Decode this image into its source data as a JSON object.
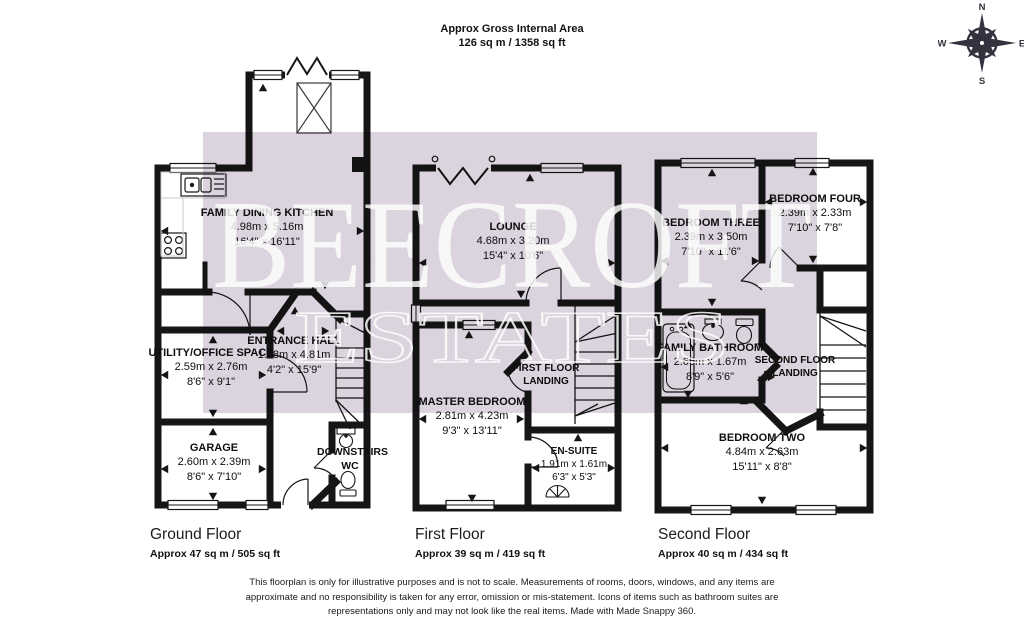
{
  "title": {
    "line1": "Approx Gross Internal Area",
    "line2": "126 sq m / 1358 sq ft"
  },
  "compass": {
    "north": "N",
    "east": "E",
    "south": "S",
    "west": "W"
  },
  "watermark": {
    "primary": "BEECROFT",
    "secondary": "ESTATES"
  },
  "colors": {
    "wall": "#161616",
    "watermark_fill": "#dbd3dd",
    "watermark_text": "#ffffff"
  },
  "floors": {
    "ground": {
      "caption": "Ground Floor",
      "area": "Approx 47 sq m / 505 sq ft",
      "rooms": {
        "kitchen": {
          "name": "FAMILY DINING KITCHEN",
          "metric": "4.98m x 5.16m",
          "imperial": "16'4\" x 16'11\""
        },
        "utility": {
          "name": "UTILITY/OFFICE SPACE",
          "metric": "2.59m x 2.76m",
          "imperial": "8'6\" x 9'1\""
        },
        "hall": {
          "name": "ENTRANCE HALL",
          "metric": "1.28m x 4.81m",
          "imperial": "4'2\" x 15'9\""
        },
        "garage": {
          "name": "GARAGE",
          "metric": "2.60m x 2.39m",
          "imperial": "8'6\" x 7'10\""
        },
        "wc": {
          "name": "DOWNSTAIRS WC"
        }
      }
    },
    "first": {
      "caption": "First Floor",
      "area": "Approx 39 sq m / 419 sq ft",
      "rooms": {
        "lounge": {
          "name": "LOUNGE",
          "metric": "4.68m x 3.20m",
          "imperial": "15'4\" x 10'6\""
        },
        "landing": {
          "name": "FIRST FLOOR LANDING"
        },
        "master": {
          "name": "MASTER BEDROOM",
          "metric": "2.81m x 4.23m",
          "imperial": "9'3\" x 13'11\""
        },
        "ensuite": {
          "name": "EN-SUITE",
          "metric": "1.91m x 1.61m",
          "imperial": "6'3\" x 5'3\""
        }
      }
    },
    "second": {
      "caption": "Second Floor",
      "area": "Approx 40 sq m / 434 sq ft",
      "rooms": {
        "bed3": {
          "name": "BEDROOM THREE",
          "metric": "2.39m x 3.50m",
          "imperial": "7'10\" x 11'6\""
        },
        "bed4": {
          "name": "BEDROOM FOUR",
          "metric": "2.39m x 2.33m",
          "imperial": "7'10\" x 7'8\""
        },
        "bathroom": {
          "name": "FAMILY BATHROOM",
          "metric": "2.66m x 1.67m",
          "imperial": "8'9\" x 5'6\""
        },
        "landing": {
          "name": "SECOND FLOOR LANDING"
        },
        "bed2": {
          "name": "BEDROOM TWO",
          "metric": "4.84m x 2.63m",
          "imperial": "15'11\" x 8'8\""
        }
      }
    }
  },
  "disclaimer": "This floorplan is only for illustrative purposes and is not to scale. Measurements of rooms, doors, windows, and any items are approximate and no responsibility is taken for any error, omission or mis-statement. Icons of items such as bathroom suites are representations only and may not look like the real items. Made with Made Snappy 360."
}
